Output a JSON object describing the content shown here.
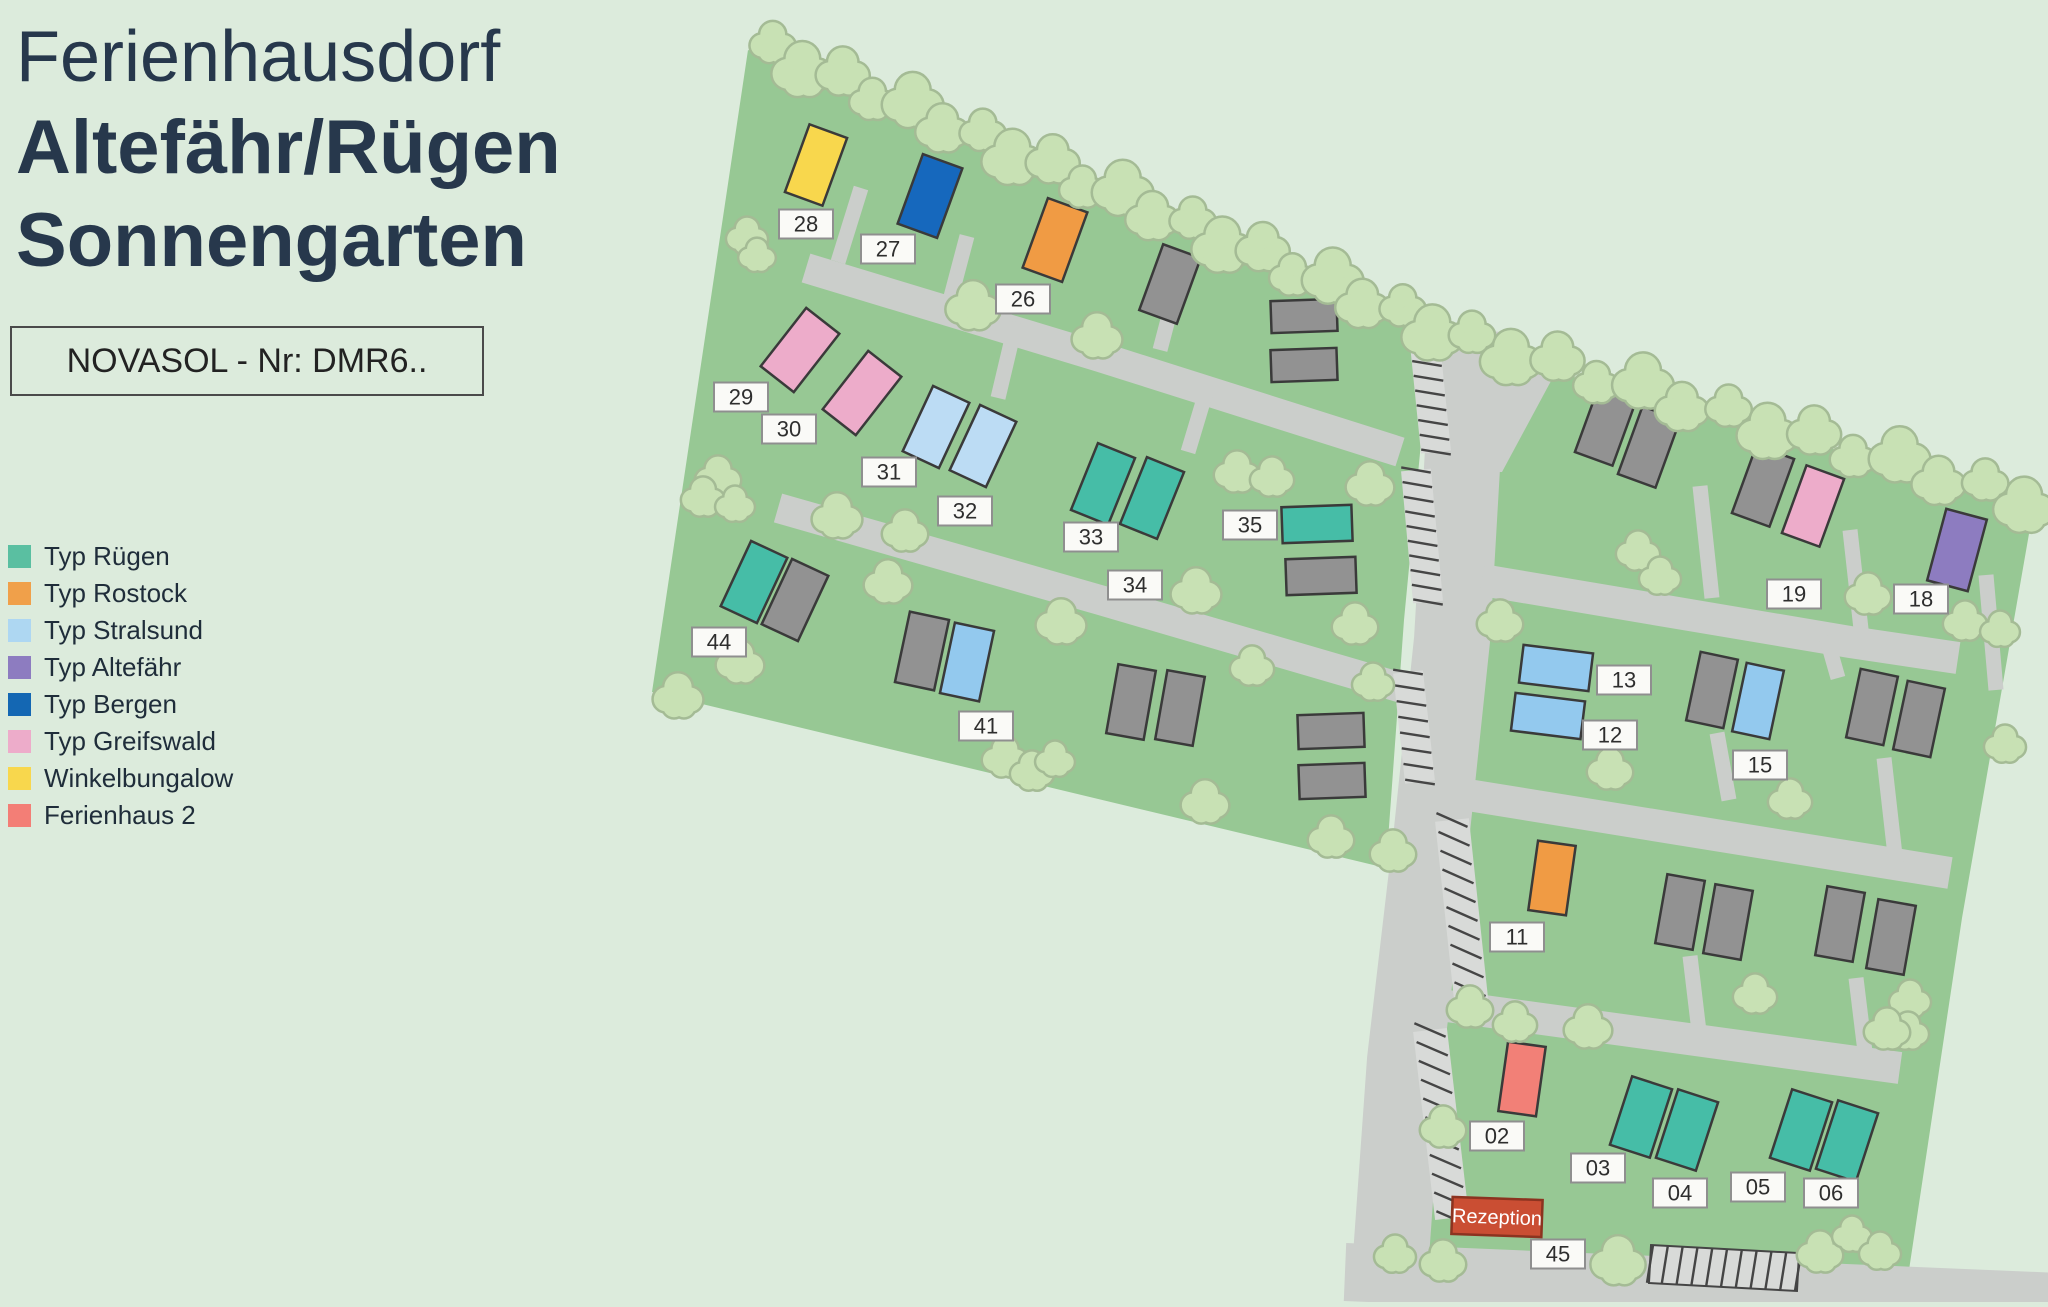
{
  "page": {
    "bg": "#dcebdc"
  },
  "title": {
    "line1": "Ferienhausdorf",
    "line2": "Altefähr/Rügen",
    "line3": "Sonnengarten"
  },
  "ref_box": {
    "text": "NOVASOL - Nr: DMR6.."
  },
  "legend": {
    "items": [
      {
        "key": "ruegen",
        "label": "Typ Rügen",
        "color": "#5abfa1"
      },
      {
        "key": "rostock",
        "label": "Typ Rostock",
        "color": "#f0a04a"
      },
      {
        "key": "stralsund",
        "label": "Typ Stralsund",
        "color": "#aed7f2"
      },
      {
        "key": "altefaehr",
        "label": "Typ Altefähr",
        "color": "#8d7cc0"
      },
      {
        "key": "bergen",
        "label": "Typ Bergen",
        "color": "#1467b3"
      },
      {
        "key": "greifswald",
        "label": "Typ Greifswald",
        "color": "#edacca"
      },
      {
        "key": "winkel",
        "label": "Winkelbungalow",
        "color": "#f8d74d"
      },
      {
        "key": "ferienhaus2",
        "label": "Ferienhaus 2",
        "color": "#f37e76"
      }
    ]
  },
  "map": {
    "colors": {
      "ground": "#97c894",
      "road": "#cbcecb",
      "stall": "#d8dad8",
      "tick": "#454545",
      "tree_fill": "#c8e1b4",
      "tree_edge": "#a4bb95",
      "house_stroke": "#3a3a3a",
      "label_bg": "#fafaf7",
      "label_border": "#8f8f8f",
      "label_text": "#2e2e2e"
    },
    "house_colors": {
      "ruegen": "#46bda7",
      "rostock": "#f09b44",
      "stralsund": "#93c9ee",
      "stralsund_light": "#bcdcf4",
      "altefaehr": "#8d7cc0",
      "bergen": "#1668bd",
      "greifswald": "#edacca",
      "winkel": "#f8d74d",
      "ferienhaus2": "#f28077",
      "na": "#929292"
    },
    "sections": [
      [
        [
          748,
          50
        ],
        [
          1432,
          328
        ],
        [
          1404,
          620
        ],
        [
          1386,
          868
        ],
        [
          652,
          692
        ]
      ],
      [
        [
          1556,
          372
        ],
        [
          2034,
          505
        ],
        [
          1962,
          918
        ],
        [
          1906,
          1290
        ],
        [
          1420,
          1262
        ],
        [
          1447,
          1010
        ],
        [
          1471,
          800
        ],
        [
          1482,
          640
        ],
        [
          1492,
          480
        ]
      ]
    ],
    "roads": [
      {
        "pts": [
          [
            1470,
            330
          ],
          [
            1452,
            640
          ],
          [
            1432,
            830
          ],
          [
            1405,
            1060
          ],
          [
            1390,
            1270
          ]
        ],
        "w": 76
      },
      {
        "pts": [
          [
            1345,
            1272
          ],
          [
            2060,
            1302
          ]
        ],
        "w": 58
      },
      {
        "pts": [
          [
            806,
            268
          ],
          [
            1100,
            357
          ],
          [
            1400,
            452
          ]
        ],
        "w": 30
      },
      {
        "pts": [
          [
            778,
            508
          ],
          [
            1100,
            600
          ],
          [
            1402,
            688
          ]
        ],
        "w": 30
      },
      {
        "pts": [
          [
            1482,
            580
          ],
          [
            1850,
            642
          ],
          [
            1958,
            658
          ]
        ],
        "w": 32
      },
      {
        "pts": [
          [
            1468,
            795
          ],
          [
            1950,
            873
          ]
        ],
        "w": 32
      },
      {
        "pts": [
          [
            1440,
            1005
          ],
          [
            1900,
            1068
          ]
        ],
        "w": 32
      }
    ],
    "road_patches": [
      [
        [
          1432,
          326
        ],
        [
          1558,
          368
        ],
        [
          1502,
          472
        ],
        [
          1434,
          472
        ]
      ]
    ],
    "driveways": [
      [
        861,
        188,
        838,
        262
      ],
      [
        967,
        236,
        948,
        308
      ],
      [
        1177,
        285,
        1160,
        350
      ],
      [
        1016,
        322,
        998,
        398
      ],
      [
        1206,
        392,
        1188,
        452
      ],
      [
        1700,
        486,
        1712,
        598
      ],
      [
        1850,
        530,
        1862,
        638
      ],
      [
        1986,
        575,
        1996,
        690
      ],
      [
        1826,
        636,
        1838,
        678
      ],
      [
        1717,
        733,
        1729,
        800
      ],
      [
        1884,
        758,
        1896,
        864
      ],
      [
        1690,
        956,
        1700,
        1040
      ],
      [
        1856,
        978,
        1866,
        1060
      ]
    ],
    "parking": [
      {
        "a": [
          1424,
          334
        ],
        "b": [
          1436,
          452
        ],
        "w": 30,
        "n": 8,
        "tick": 15,
        "outline": false
      },
      {
        "a": [
          1416,
          470
        ],
        "b": [
          1428,
          602
        ],
        "w": 30,
        "n": 9,
        "tick": 15,
        "outline": false
      },
      {
        "a": [
          1408,
          672
        ],
        "b": [
          1420,
          782
        ],
        "w": 30,
        "n": 7,
        "tick": 15,
        "outline": false
      },
      {
        "a": [
          1452,
          820
        ],
        "b": [
          1472,
          1008
        ],
        "w": 34,
        "n": 10,
        "tick": 30,
        "outline": false
      },
      {
        "a": [
          1430,
          1030
        ],
        "b": [
          1452,
          1218
        ],
        "w": 34,
        "n": 10,
        "tick": 30,
        "outline": false
      },
      {
        "a": [
          1650,
          1264
        ],
        "b": [
          1798,
          1272
        ],
        "w": 38,
        "n": 10,
        "tick": 6,
        "outline": true
      }
    ],
    "tree_rows": [
      {
        "a": [
          770,
          50
        ],
        "b": [
          1435,
          328
        ],
        "n": 20
      },
      {
        "a": [
          1470,
          340
        ],
        "b": [
          2026,
          500
        ],
        "n": 14
      }
    ],
    "trees": [
      [
        973,
        307,
        24
      ],
      [
        1097,
        337,
        22
      ],
      [
        747,
        237,
        18
      ],
      [
        757,
        256,
        16
      ],
      [
        718,
        478,
        20
      ],
      [
        703,
        498,
        19
      ],
      [
        735,
        505,
        17
      ],
      [
        837,
        517,
        22
      ],
      [
        905,
        532,
        20
      ],
      [
        888,
        583,
        21
      ],
      [
        1061,
        623,
        22
      ],
      [
        740,
        663,
        21
      ],
      [
        678,
        697,
        22
      ],
      [
        1005,
        758,
        20
      ],
      [
        1032,
        772,
        19
      ],
      [
        1055,
        760,
        17
      ],
      [
        1196,
        592,
        22
      ],
      [
        1237,
        473,
        20
      ],
      [
        1272,
        478,
        19
      ],
      [
        1370,
        485,
        21
      ],
      [
        1355,
        625,
        20
      ],
      [
        1252,
        667,
        19
      ],
      [
        1373,
        683,
        18
      ],
      [
        1205,
        803,
        21
      ],
      [
        1331,
        838,
        20
      ],
      [
        1393,
        852,
        20
      ],
      [
        1638,
        552,
        19
      ],
      [
        1660,
        577,
        18
      ],
      [
        1868,
        595,
        20
      ],
      [
        1500,
        622,
        20
      ],
      [
        1965,
        622,
        19
      ],
      [
        2000,
        630,
        17
      ],
      [
        1610,
        770,
        20
      ],
      [
        1790,
        800,
        19
      ],
      [
        2005,
        745,
        18
      ],
      [
        1755,
        995,
        19
      ],
      [
        1910,
        1000,
        18
      ],
      [
        1908,
        1032,
        18
      ],
      [
        1470,
        1008,
        20
      ],
      [
        1515,
        1023,
        19
      ],
      [
        1588,
        1028,
        21
      ],
      [
        1887,
        1030,
        20
      ],
      [
        1443,
        1128,
        20
      ],
      [
        1395,
        1255,
        18
      ],
      [
        1443,
        1262,
        20
      ],
      [
        1618,
        1262,
        24
      ],
      [
        1820,
        1253,
        20
      ],
      [
        1852,
        1235,
        17
      ],
      [
        1880,
        1252,
        18
      ]
    ],
    "houses": [
      {
        "num": "28",
        "type": "winkel",
        "x": 816,
        "y": 165,
        "w": 40,
        "h": 72,
        "rot": 20
      },
      {
        "num": "27",
        "type": "bergen",
        "x": 930,
        "y": 196,
        "w": 42,
        "h": 74,
        "rot": 20
      },
      {
        "num": "26",
        "type": "rostock",
        "x": 1055,
        "y": 240,
        "w": 42,
        "h": 74,
        "rot": 20
      },
      {
        "num": null,
        "type": "na",
        "x": 1170,
        "y": 284,
        "w": 40,
        "h": 70,
        "rot": 20
      },
      {
        "num": null,
        "type": "na",
        "x": 1304,
        "y": 316,
        "w": 66,
        "h": 32,
        "rot": -2
      },
      {
        "num": null,
        "type": "na",
        "x": 1304,
        "y": 365,
        "w": 66,
        "h": 32,
        "rot": -2
      },
      {
        "num": "29",
        "type": "greifswald",
        "x": 800,
        "y": 350,
        "w": 42,
        "h": 74,
        "rot": 38
      },
      {
        "num": "30",
        "type": "greifswald",
        "x": 862,
        "y": 393,
        "w": 42,
        "h": 74,
        "rot": 38
      },
      {
        "num": "31",
        "type": "stralsund_light",
        "x": 936,
        "y": 427,
        "w": 40,
        "h": 72,
        "rot": 25
      },
      {
        "num": "32",
        "type": "stralsund_light",
        "x": 983,
        "y": 446,
        "w": 40,
        "h": 72,
        "rot": 25
      },
      {
        "num": "33",
        "type": "ruegen",
        "x": 1103,
        "y": 484,
        "w": 40,
        "h": 72,
        "rot": 22
      },
      {
        "num": "34",
        "type": "ruegen",
        "x": 1152,
        "y": 498,
        "w": 40,
        "h": 72,
        "rot": 22
      },
      {
        "num": "35",
        "type": "ruegen",
        "x": 1317,
        "y": 524,
        "w": 70,
        "h": 36,
        "rot": -2
      },
      {
        "num": null,
        "type": "na",
        "x": 1321,
        "y": 576,
        "w": 70,
        "h": 36,
        "rot": -2
      },
      {
        "num": "44",
        "type": "ruegen",
        "x": 754,
        "y": 582,
        "w": 40,
        "h": 72,
        "rot": 25
      },
      {
        "num": null,
        "type": "na",
        "x": 795,
        "y": 600,
        "w": 40,
        "h": 72,
        "rot": 25
      },
      {
        "num": null,
        "type": "na",
        "x": 922,
        "y": 651,
        "w": 40,
        "h": 72,
        "rot": 12
      },
      {
        "num": "41",
        "type": "stralsund",
        "x": 967,
        "y": 662,
        "w": 40,
        "h": 72,
        "rot": 12
      },
      {
        "num": null,
        "type": "na",
        "x": 1131,
        "y": 702,
        "w": 38,
        "h": 70,
        "rot": 10
      },
      {
        "num": null,
        "type": "na",
        "x": 1180,
        "y": 708,
        "w": 38,
        "h": 70,
        "rot": 10
      },
      {
        "num": null,
        "type": "na",
        "x": 1331,
        "y": 731,
        "w": 66,
        "h": 34,
        "rot": -2
      },
      {
        "num": null,
        "type": "na",
        "x": 1332,
        "y": 781,
        "w": 66,
        "h": 34,
        "rot": -2
      },
      {
        "num": null,
        "type": "na",
        "x": 1606,
        "y": 425,
        "w": 40,
        "h": 72,
        "rot": 20
      },
      {
        "num": null,
        "type": "na",
        "x": 1649,
        "y": 447,
        "w": 40,
        "h": 72,
        "rot": 20
      },
      {
        "num": null,
        "type": "na",
        "x": 1763,
        "y": 486,
        "w": 40,
        "h": 72,
        "rot": 20
      },
      {
        "num": "19",
        "type": "greifswald",
        "x": 1813,
        "y": 506,
        "w": 40,
        "h": 72,
        "rot": 20
      },
      {
        "num": "18",
        "type": "altefaehr",
        "x": 1957,
        "y": 550,
        "w": 42,
        "h": 74,
        "rot": 15
      },
      {
        "num": "13",
        "type": "stralsund",
        "x": 1556,
        "y": 668,
        "w": 70,
        "h": 38,
        "rot": 7
      },
      {
        "num": "12",
        "type": "stralsund",
        "x": 1548,
        "y": 716,
        "w": 70,
        "h": 38,
        "rot": 7
      },
      {
        "num": null,
        "type": "na",
        "x": 1712,
        "y": 690,
        "w": 38,
        "h": 70,
        "rot": 12
      },
      {
        "num": "15",
        "type": "stralsund",
        "x": 1758,
        "y": 701,
        "w": 38,
        "h": 70,
        "rot": 12
      },
      {
        "num": null,
        "type": "na",
        "x": 1872,
        "y": 707,
        "w": 38,
        "h": 70,
        "rot": 12
      },
      {
        "num": null,
        "type": "na",
        "x": 1919,
        "y": 719,
        "w": 38,
        "h": 70,
        "rot": 12
      },
      {
        "num": "11",
        "type": "rostock",
        "x": 1552,
        "y": 878,
        "w": 38,
        "h": 70,
        "rot": 8
      },
      {
        "num": null,
        "type": "na",
        "x": 1680,
        "y": 912,
        "w": 38,
        "h": 70,
        "rot": 10
      },
      {
        "num": null,
        "type": "na",
        "x": 1728,
        "y": 922,
        "w": 38,
        "h": 70,
        "rot": 10
      },
      {
        "num": null,
        "type": "na",
        "x": 1840,
        "y": 924,
        "w": 38,
        "h": 70,
        "rot": 10
      },
      {
        "num": null,
        "type": "na",
        "x": 1891,
        "y": 937,
        "w": 38,
        "h": 70,
        "rot": 10
      },
      {
        "num": "02",
        "type": "ferienhaus2",
        "x": 1522,
        "y": 1079,
        "w": 38,
        "h": 70,
        "rot": 8
      },
      {
        "num": "03",
        "type": "ruegen",
        "x": 1641,
        "y": 1117,
        "w": 42,
        "h": 72,
        "rot": 18
      },
      {
        "num": "04",
        "type": "ruegen",
        "x": 1687,
        "y": 1130,
        "w": 42,
        "h": 72,
        "rot": 18
      },
      {
        "num": "05",
        "type": "ruegen",
        "x": 1801,
        "y": 1130,
        "w": 42,
        "h": 72,
        "rot": 18
      },
      {
        "num": "06",
        "type": "ruegen",
        "x": 1847,
        "y": 1141,
        "w": 42,
        "h": 72,
        "rot": 18
      }
    ],
    "labels": [
      {
        "text": "28",
        "x": 806,
        "y": 224
      },
      {
        "text": "27",
        "x": 888,
        "y": 249
      },
      {
        "text": "26",
        "x": 1023,
        "y": 299
      },
      {
        "text": "29",
        "x": 741,
        "y": 397
      },
      {
        "text": "30",
        "x": 789,
        "y": 429
      },
      {
        "text": "31",
        "x": 889,
        "y": 472
      },
      {
        "text": "32",
        "x": 965,
        "y": 511
      },
      {
        "text": "33",
        "x": 1091,
        "y": 537
      },
      {
        "text": "34",
        "x": 1135,
        "y": 585
      },
      {
        "text": "35",
        "x": 1250,
        "y": 525
      },
      {
        "text": "44",
        "x": 719,
        "y": 642
      },
      {
        "text": "41",
        "x": 986,
        "y": 726
      },
      {
        "text": "19",
        "x": 1794,
        "y": 594
      },
      {
        "text": "18",
        "x": 1921,
        "y": 599
      },
      {
        "text": "13",
        "x": 1624,
        "y": 680
      },
      {
        "text": "12",
        "x": 1610,
        "y": 735
      },
      {
        "text": "15",
        "x": 1760,
        "y": 765
      },
      {
        "text": "11",
        "x": 1517,
        "y": 937
      },
      {
        "text": "02",
        "x": 1497,
        "y": 1136
      },
      {
        "text": "03",
        "x": 1598,
        "y": 1168
      },
      {
        "text": "04",
        "x": 1680,
        "y": 1193
      },
      {
        "text": "05",
        "x": 1758,
        "y": 1187
      },
      {
        "text": "06",
        "x": 1831,
        "y": 1193
      },
      {
        "text": "45",
        "x": 1558,
        "y": 1254
      }
    ],
    "reception": {
      "text": "Rezeption",
      "x": 1497,
      "y": 1217,
      "w": 90,
      "h": 37,
      "rot": 2,
      "fill": "#ca4e33",
      "border": "#8c3320",
      "text_color": "#ffffff"
    }
  }
}
